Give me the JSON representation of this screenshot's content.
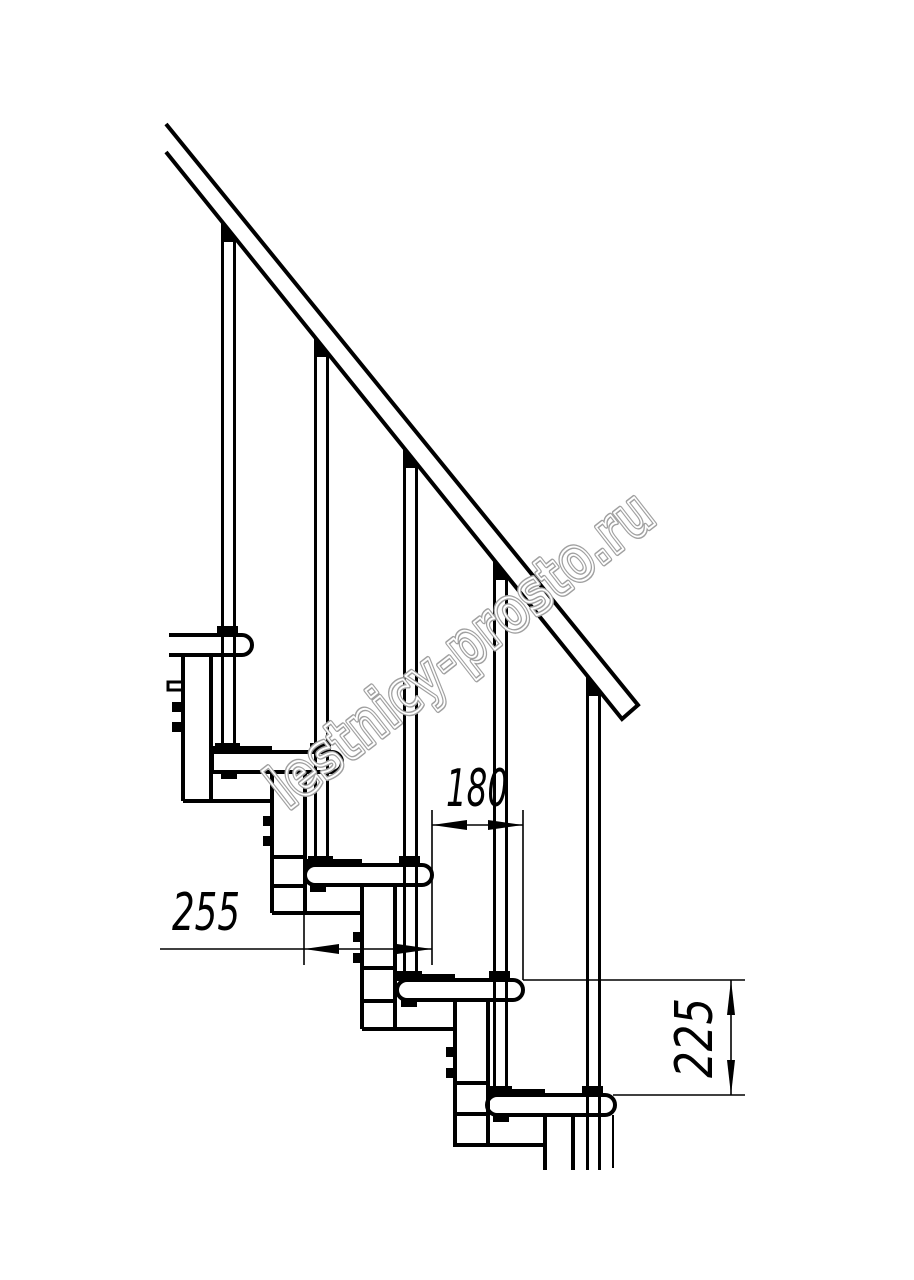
{
  "drawing": {
    "title": "modular-staircase-side-view",
    "dimensions": {
      "tread_depth_label": "255",
      "step_run_label": "180",
      "step_rise_label": "225"
    },
    "watermark": "lestnicy-prosto.ru",
    "colors": {
      "line": "#000000",
      "watermark": "#a0a0a0",
      "background": "#ffffff"
    }
  }
}
